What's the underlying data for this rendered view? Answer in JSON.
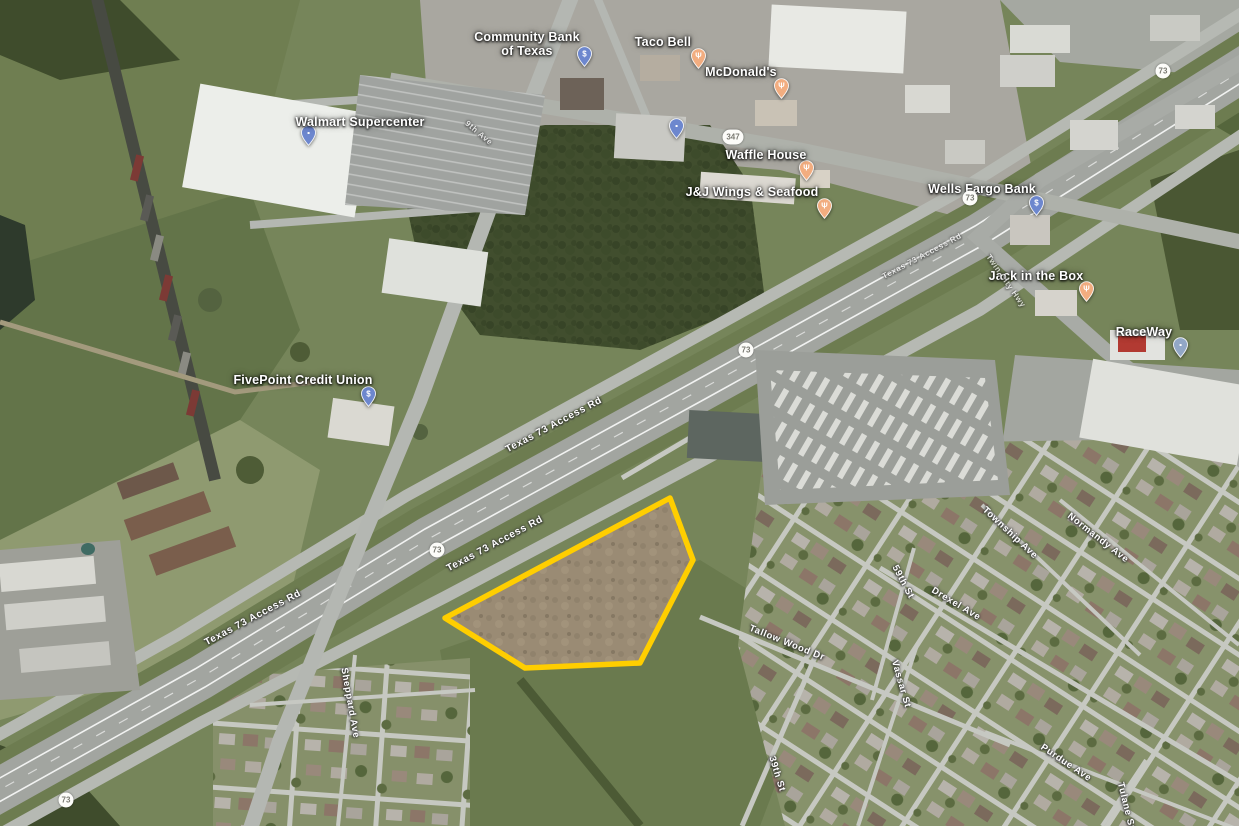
{
  "map": {
    "view": "satellite-aerial",
    "parcel": {
      "description": "highlighted vacant land parcel",
      "outline_color": "#FFCE00",
      "fill_color": "#9a8b74",
      "points": "445,618 670,498 693,560 640,663 525,668"
    },
    "pois": [
      {
        "id": "community-bank-of-texas",
        "lines": [
          "Community Bank",
          "of Texas"
        ],
        "label_x": 527,
        "label_y": 44,
        "pin_x": 577,
        "pin_y": 46,
        "pin_color": "#6d87ce",
        "glyph": "$",
        "category": "bank"
      },
      {
        "id": "taco-bell",
        "lines": [
          "Taco Bell"
        ],
        "label_x": 663,
        "label_y": 42,
        "pin_x": 691,
        "pin_y": 48,
        "pin_color": "#f2ad80",
        "glyph": "Ψ",
        "category": "restaurant"
      },
      {
        "id": "walmart-supercenter",
        "lines": [
          "Walmart Supercenter"
        ],
        "label_x": 360,
        "label_y": 122,
        "pin_x": 301,
        "pin_y": 125,
        "pin_color": "#6d87ce",
        "glyph": "▪",
        "category": "store"
      },
      {
        "id": "unlabeled-store",
        "lines": null,
        "pin_x": 669,
        "pin_y": 118,
        "pin_color": "#6d87ce",
        "glyph": "▪",
        "category": "store"
      },
      {
        "id": "mcdonalds",
        "lines": [
          "McDonald's"
        ],
        "label_x": 741,
        "label_y": 72,
        "pin_x": 774,
        "pin_y": 78,
        "pin_color": "#f2ad80",
        "glyph": "Ψ",
        "category": "restaurant"
      },
      {
        "id": "waffle-house",
        "lines": [
          "Waffle House"
        ],
        "label_x": 766,
        "label_y": 155,
        "pin_x": 799,
        "pin_y": 160,
        "pin_color": "#f2ad80",
        "glyph": "Ψ",
        "category": "restaurant"
      },
      {
        "id": "jj-wings-and-seafood",
        "lines": [
          "J&J Wings & Seafood"
        ],
        "label_x": 752,
        "label_y": 192,
        "pin_x": 817,
        "pin_y": 198,
        "pin_color": "#f2ad80",
        "glyph": "Ψ",
        "category": "restaurant"
      },
      {
        "id": "wells-fargo-bank",
        "lines": [
          "Wells Fargo Bank"
        ],
        "label_x": 982,
        "label_y": 189,
        "pin_x": 1029,
        "pin_y": 195,
        "pin_color": "#6d87ce",
        "glyph": "$",
        "category": "bank"
      },
      {
        "id": "jack-in-the-box",
        "lines": [
          "Jack in the Box"
        ],
        "label_x": 1036,
        "label_y": 276,
        "pin_x": 1079,
        "pin_y": 281,
        "pin_color": "#f2ad80",
        "glyph": "Ψ",
        "category": "restaurant"
      },
      {
        "id": "raceway",
        "lines": [
          "RaceWay"
        ],
        "label_x": 1144,
        "label_y": 332,
        "pin_x": 1173,
        "pin_y": 337,
        "pin_color": "#92a7c6",
        "glyph": "▪",
        "category": "gas-station"
      },
      {
        "id": "fivepoint-credit-union",
        "lines": [
          "FivePoint Credit Union"
        ],
        "label_x": 303,
        "label_y": 380,
        "pin_x": 361,
        "pin_y": 386,
        "pin_color": "#6d87ce",
        "glyph": "$",
        "category": "bank"
      }
    ],
    "road_labels": [
      {
        "text": "Texas 73 Access Rd",
        "x": 554,
        "y": 425,
        "rot": -28,
        "size": 10
      },
      {
        "text": "Texas 73 Access Rd",
        "x": 495,
        "y": 544,
        "rot": -28,
        "size": 10
      },
      {
        "text": "Texas 73 Access Rd",
        "x": 253,
        "y": 618,
        "rot": -28,
        "size": 10
      },
      {
        "text": "Texas 73 Access Rd",
        "x": 922,
        "y": 256,
        "rot": -28,
        "size": 8,
        "faint": true
      },
      {
        "text": "9th Ave",
        "x": 479,
        "y": 133,
        "rot": 40,
        "size": 8,
        "faint": true
      },
      {
        "text": "Twin City Hwy",
        "x": 1006,
        "y": 281,
        "rot": 55,
        "size": 8,
        "faint": true
      },
      {
        "text": "Township Ave",
        "x": 1010,
        "y": 533,
        "rot": 43,
        "size": 9.5
      },
      {
        "text": "Normandy Ave",
        "x": 1098,
        "y": 538,
        "rot": 38,
        "size": 9.5
      },
      {
        "text": "Drexel Ave",
        "x": 956,
        "y": 604,
        "rot": 31,
        "size": 9.5
      },
      {
        "text": "59th St",
        "x": 903,
        "y": 582,
        "rot": 62,
        "size": 9.5
      },
      {
        "text": "Tallow Wood Dr",
        "x": 787,
        "y": 643,
        "rot": 22,
        "size": 9.5
      },
      {
        "text": "39th St",
        "x": 777,
        "y": 774,
        "rot": 73,
        "size": 9.5
      },
      {
        "text": "Sheppard Ave",
        "x": 350,
        "y": 703,
        "rot": 80,
        "size": 9.5
      },
      {
        "text": "Vassar St",
        "x": 901,
        "y": 684,
        "rot": 74,
        "size": 9.5
      },
      {
        "text": "Purdue Ave",
        "x": 1066,
        "y": 763,
        "rot": 34,
        "size": 9.5
      },
      {
        "text": "Tulane St",
        "x": 1126,
        "y": 806,
        "rot": 76,
        "size": 9.5
      }
    ],
    "route_shields": [
      {
        "text": "347",
        "x": 733,
        "y": 137
      },
      {
        "text": "73",
        "x": 970,
        "y": 198
      },
      {
        "text": "73",
        "x": 746,
        "y": 350
      },
      {
        "text": "73",
        "x": 437,
        "y": 550
      },
      {
        "text": "73",
        "x": 66,
        "y": 800
      },
      {
        "text": "73",
        "x": 1163,
        "y": 71
      }
    ]
  }
}
